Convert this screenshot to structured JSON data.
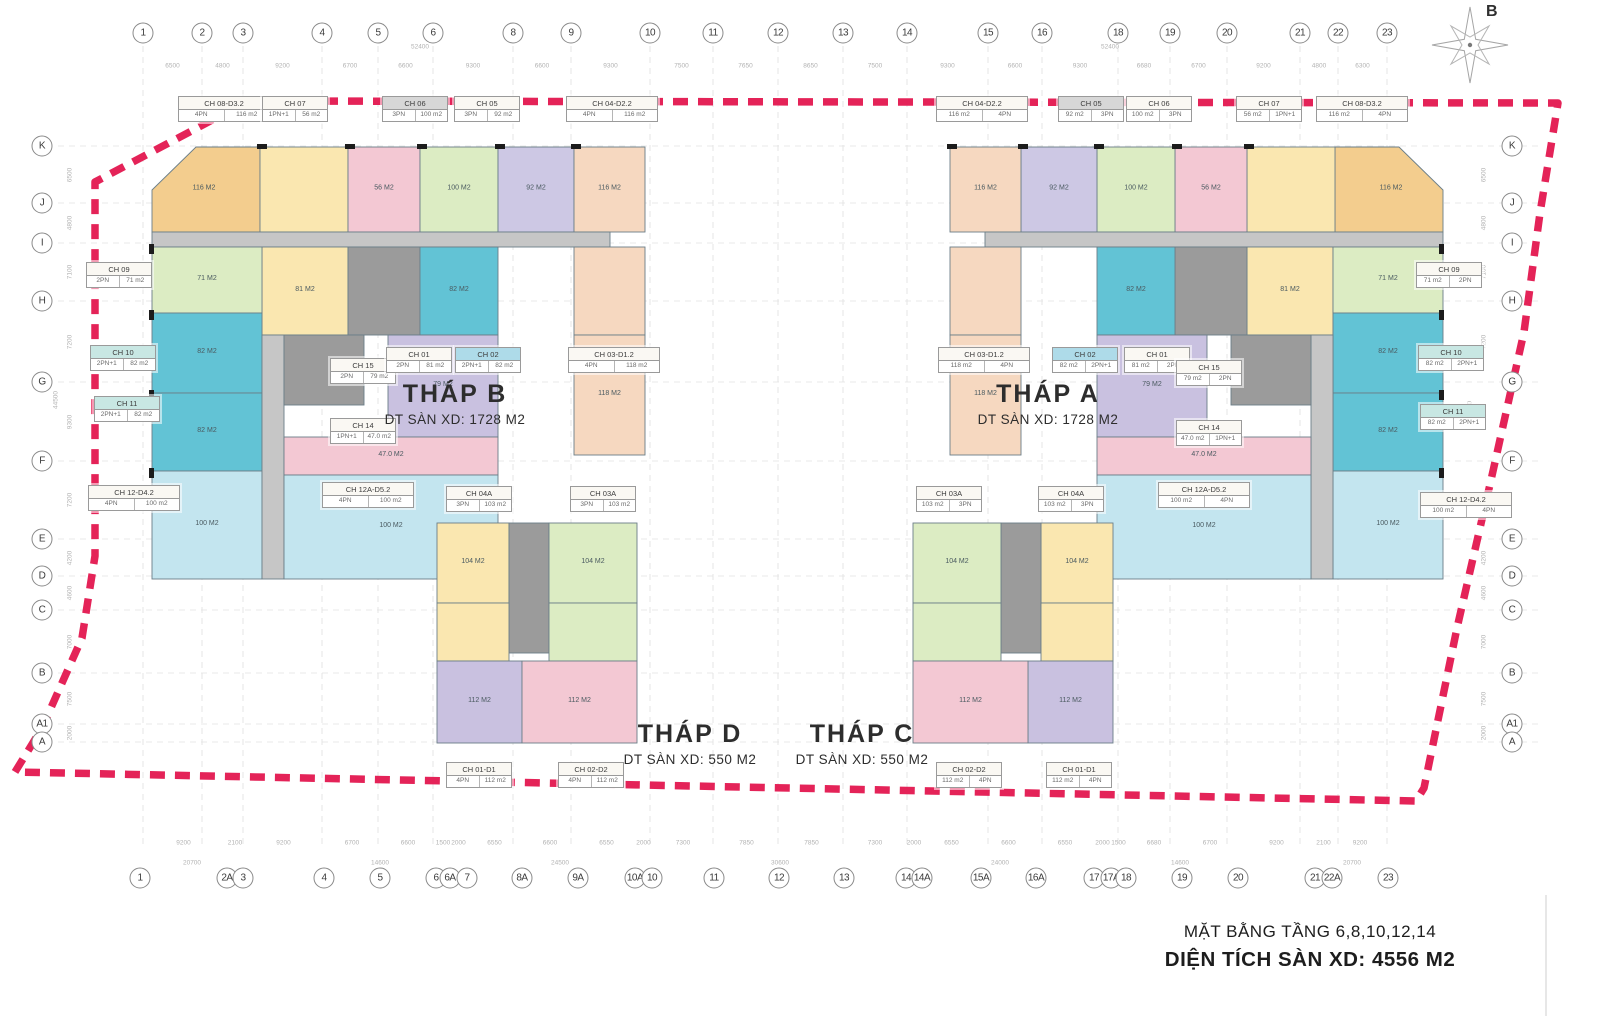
{
  "title_block": {
    "line1": "MẶT BẰNG TẦNG 6,8,10,12,14",
    "line2": "DIỆN TÍCH SÀN XD: 4556 M2"
  },
  "compass": {
    "label": "B"
  },
  "towers": [
    {
      "name": "THÁP B",
      "area": "DT SÀN XD: 1728 M2",
      "x": 455,
      "y": 380
    },
    {
      "name": "THÁP A",
      "area": "DT SÀN XD: 1728 M2",
      "x": 1048,
      "y": 380
    },
    {
      "name": "THÁP D",
      "area": "DT SÀN XD: 550 M2",
      "x": 690,
      "y": 720
    },
    {
      "name": "THÁP C",
      "area": "DT SÀN XD: 550 M2",
      "x": 862,
      "y": 720
    }
  ],
  "axes": {
    "top": [
      {
        "l": "1",
        "x": 143
      },
      {
        "l": "2",
        "x": 202
      },
      {
        "l": "3",
        "x": 243
      },
      {
        "l": "4",
        "x": 322
      },
      {
        "l": "5",
        "x": 378
      },
      {
        "l": "6",
        "x": 433
      },
      {
        "l": "8",
        "x": 513
      },
      {
        "l": "9",
        "x": 571
      },
      {
        "l": "10",
        "x": 650
      },
      {
        "l": "11",
        "x": 713
      },
      {
        "l": "12",
        "x": 778
      },
      {
        "l": "13",
        "x": 843
      },
      {
        "l": "14",
        "x": 907
      },
      {
        "l": "15",
        "x": 988
      },
      {
        "l": "16",
        "x": 1042
      },
      {
        "l": "18",
        "x": 1118
      },
      {
        "l": "19",
        "x": 1170
      },
      {
        "l": "20",
        "x": 1227
      },
      {
        "l": "21",
        "x": 1300
      },
      {
        "l": "22",
        "x": 1338
      },
      {
        "l": "23",
        "x": 1387
      }
    ],
    "bottom": [
      {
        "l": "1",
        "x": 140
      },
      {
        "l": "2A",
        "x": 227
      },
      {
        "l": "3",
        "x": 243
      },
      {
        "l": "4",
        "x": 324
      },
      {
        "l": "5",
        "x": 380
      },
      {
        "l": "6",
        "x": 436
      },
      {
        "l": "6A",
        "x": 450
      },
      {
        "l": "7",
        "x": 467
      },
      {
        "l": "8A",
        "x": 522
      },
      {
        "l": "9A",
        "x": 578
      },
      {
        "l": "10A",
        "x": 635
      },
      {
        "l": "10",
        "x": 652
      },
      {
        "l": "11",
        "x": 714
      },
      {
        "l": "12",
        "x": 779
      },
      {
        "l": "13",
        "x": 844
      },
      {
        "l": "14",
        "x": 906
      },
      {
        "l": "14A",
        "x": 922
      },
      {
        "l": "15A",
        "x": 981
      },
      {
        "l": "16A",
        "x": 1036
      },
      {
        "l": "17",
        "x": 1094
      },
      {
        "l": "17A",
        "x": 1111
      },
      {
        "l": "18",
        "x": 1126
      },
      {
        "l": "19",
        "x": 1182
      },
      {
        "l": "20",
        "x": 1238
      },
      {
        "l": "21",
        "x": 1315
      },
      {
        "l": "22A",
        "x": 1332
      },
      {
        "l": "23",
        "x": 1388
      }
    ],
    "left": [
      {
        "l": "K",
        "y": 146
      },
      {
        "l": "J",
        "y": 203
      },
      {
        "l": "I",
        "y": 243
      },
      {
        "l": "H",
        "y": 301
      },
      {
        "l": "G",
        "y": 382
      },
      {
        "l": "F",
        "y": 461
      },
      {
        "l": "E",
        "y": 539
      },
      {
        "l": "D",
        "y": 576
      },
      {
        "l": "C",
        "y": 610
      },
      {
        "l": "B",
        "y": 673
      },
      {
        "l": "A1",
        "y": 724
      },
      {
        "l": "A",
        "y": 742
      }
    ],
    "right": [
      {
        "l": "K",
        "y": 146
      },
      {
        "l": "J",
        "y": 203
      },
      {
        "l": "I",
        "y": 243
      },
      {
        "l": "H",
        "y": 301
      },
      {
        "l": "G",
        "y": 382
      },
      {
        "l": "F",
        "y": 461
      },
      {
        "l": "E",
        "y": 539
      },
      {
        "l": "D",
        "y": 576
      },
      {
        "l": "C",
        "y": 610
      },
      {
        "l": "B",
        "y": 673
      },
      {
        "l": "A1",
        "y": 724
      },
      {
        "l": "A",
        "y": 742
      }
    ]
  },
  "dims": {
    "top": [
      "6500",
      "4800",
      "9200",
      "6700",
      "6600",
      "9300",
      "6600",
      "9300",
      "7500",
      "7650",
      "8650",
      "7500",
      "9300",
      "6600",
      "9300",
      "6680",
      "6700",
      "9200",
      "4800",
      "6300"
    ],
    "top_overall": [
      {
        "v": "52400",
        "x": 420
      },
      {
        "v": "52400",
        "x": 1110
      }
    ],
    "bottom": [
      "9200",
      "2100",
      "9200",
      "6700",
      "6600",
      "1500",
      "2000",
      "6550",
      "6600",
      "6550",
      "2000",
      "7300",
      "7850",
      "7850",
      "7300",
      "2000",
      "6550",
      "6600",
      "6550",
      "2000",
      "1500",
      "6680",
      "6700",
      "9200",
      "2100",
      "9200"
    ],
    "bottom_overall": [
      {
        "v": "20700",
        "x": 192
      },
      {
        "v": "14600",
        "x": 380
      },
      {
        "v": "24500",
        "x": 560
      },
      {
        "v": "30600",
        "x": 780
      },
      {
        "v": "24000",
        "x": 1000
      },
      {
        "v": "14600",
        "x": 1180
      },
      {
        "v": "20700",
        "x": 1352
      }
    ],
    "side": [
      "6500",
      "4800",
      "7100",
      "7200",
      "9300",
      "7200",
      "4200",
      "4600",
      "7000",
      "7500",
      "2000"
    ],
    "side_overall": "44500"
  },
  "unit_labels": [
    {
      "n": "CH 08-D3.2",
      "a": "4PN",
      "b": "116 m2",
      "x": 178,
      "y": 96,
      "hl": "none"
    },
    {
      "n": "CH 07",
      "a": "1PN+1",
      "b": "56 m2",
      "x": 262,
      "y": 96,
      "hl": "none"
    },
    {
      "n": "CH 06",
      "a": "3PN",
      "b": "100 m2",
      "x": 382,
      "y": 96,
      "hl": "gray"
    },
    {
      "n": "CH 05",
      "a": "3PN",
      "b": "92 m2",
      "x": 454,
      "y": 96,
      "hl": "none"
    },
    {
      "n": "CH 04-D2.2",
      "a": "4PN",
      "b": "116 m2",
      "x": 566,
      "y": 96,
      "hl": "none"
    },
    {
      "n": "CH 04-D2.2",
      "a": "116 m2",
      "b": "4PN",
      "x": 936,
      "y": 96,
      "hl": "none"
    },
    {
      "n": "CH 05",
      "a": "92 m2",
      "b": "3PN",
      "x": 1058,
      "y": 96,
      "hl": "gray"
    },
    {
      "n": "CH 06",
      "a": "100 m2",
      "b": "3PN",
      "x": 1126,
      "y": 96,
      "hl": "none"
    },
    {
      "n": "CH 07",
      "a": "56 m2",
      "b": "1PN+1",
      "x": 1236,
      "y": 96,
      "hl": "none"
    },
    {
      "n": "CH 08-D3.2",
      "a": "116 m2",
      "b": "4PN",
      "x": 1316,
      "y": 96,
      "hl": "none"
    },
    {
      "n": "CH 09",
      "a": "2PN",
      "b": "71 m2",
      "x": 86,
      "y": 262,
      "hl": "none"
    },
    {
      "n": "CH 10",
      "a": "2PN+1",
      "b": "82 m2",
      "x": 90,
      "y": 345,
      "hl": "teal"
    },
    {
      "n": "CH 11",
      "a": "2PN+1",
      "b": "82 m2",
      "x": 94,
      "y": 396,
      "hl": "teal"
    },
    {
      "n": "CH 12-D4.2",
      "a": "4PN",
      "b": "100 m2",
      "x": 88,
      "y": 485,
      "hl": "none"
    },
    {
      "n": "CH 09",
      "a": "71 m2",
      "b": "2PN",
      "x": 1416,
      "y": 262,
      "hl": "none"
    },
    {
      "n": "CH 10",
      "a": "82 m2",
      "b": "2PN+1",
      "x": 1418,
      "y": 345,
      "hl": "teal"
    },
    {
      "n": "CH 11",
      "a": "82 m2",
      "b": "2PN+1",
      "x": 1420,
      "y": 404,
      "hl": "teal"
    },
    {
      "n": "CH 12-D4.2",
      "a": "100 m2",
      "b": "4PN",
      "x": 1420,
      "y": 492,
      "hl": "none"
    },
    {
      "n": "CH 15",
      "a": "2PN",
      "b": "79 m2",
      "x": 330,
      "y": 358,
      "hl": "none"
    },
    {
      "n": "CH 01",
      "a": "2PN",
      "b": "81 m2",
      "x": 386,
      "y": 347,
      "hl": "none"
    },
    {
      "n": "CH 02",
      "a": "2PN+1",
      "b": "82 m2",
      "x": 455,
      "y": 347,
      "hl": "blue"
    },
    {
      "n": "CH 03-D1.2",
      "a": "4PN",
      "b": "118 m2",
      "x": 568,
      "y": 347,
      "hl": "none"
    },
    {
      "n": "CH 14",
      "a": "1PN+1",
      "b": "47.0 m2",
      "x": 330,
      "y": 418,
      "hl": "none"
    },
    {
      "n": "CH 03-D1.2",
      "a": "118 m2",
      "b": "4PN",
      "x": 938,
      "y": 347,
      "hl": "none"
    },
    {
      "n": "CH 02",
      "a": "82 m2",
      "b": "2PN+1",
      "x": 1052,
      "y": 347,
      "hl": "blue"
    },
    {
      "n": "CH 01",
      "a": "81 m2",
      "b": "2PN",
      "x": 1124,
      "y": 347,
      "hl": "none"
    },
    {
      "n": "CH 15",
      "a": "79 m2",
      "b": "2PN",
      "x": 1176,
      "y": 360,
      "hl": "none"
    },
    {
      "n": "CH 14",
      "a": "47.0 m2",
      "b": "1PN+1",
      "x": 1176,
      "y": 420,
      "hl": "none"
    },
    {
      "n": "CH 12A-D5.2",
      "a": "4PN",
      "b": "100 m2",
      "x": 322,
      "y": 482,
      "hl": "none"
    },
    {
      "n": "CH 04A",
      "a": "3PN",
      "b": "103 m2",
      "x": 446,
      "y": 486,
      "hl": "none"
    },
    {
      "n": "CH 03A",
      "a": "3PN",
      "b": "103 m2",
      "x": 570,
      "y": 486,
      "hl": "none"
    },
    {
      "n": "CH 03A",
      "a": "103 m2",
      "b": "3PN",
      "x": 916,
      "y": 486,
      "hl": "none"
    },
    {
      "n": "CH 04A",
      "a": "103 m2",
      "b": "3PN",
      "x": 1038,
      "y": 486,
      "hl": "none"
    },
    {
      "n": "CH 12A-D5.2",
      "a": "100 m2",
      "b": "4PN",
      "x": 1158,
      "y": 482,
      "hl": "none"
    },
    {
      "n": "CH 01-D1",
      "a": "4PN",
      "b": "112 m2",
      "x": 446,
      "y": 762,
      "hl": "none"
    },
    {
      "n": "CH 02-D2",
      "a": "4PN",
      "b": "112 m2",
      "x": 558,
      "y": 762,
      "hl": "none"
    },
    {
      "n": "CH 02-D2",
      "a": "112 m2",
      "b": "4PN",
      "x": 936,
      "y": 762,
      "hl": "none"
    },
    {
      "n": "CH 01-D1",
      "a": "112 m2",
      "b": "4PN",
      "x": 1046,
      "y": 762,
      "hl": "none"
    }
  ],
  "palette": {
    "orange": "#f3cd8e",
    "yellow": "#fae7b0",
    "pink": "#f3c8d3",
    "green": "#dcecc3",
    "lavender": "#cdc8e4",
    "peach": "#f6d8c0",
    "teal": "#62c3d5",
    "paleblue": "#c3e5ef",
    "purple": "#c9c1e0",
    "corr": "#c6c6c6",
    "core": "#9b9b9b"
  },
  "blocks": [
    {
      "pts": [
        [
          152,
          190
        ],
        [
          196,
          147
        ],
        [
          260,
          147
        ],
        [
          260,
          232
        ],
        [
          152,
          232
        ]
      ],
      "c": "orange",
      "t": "116 M2"
    },
    {
      "x": 260,
      "y": 147,
      "w": 88,
      "h": 85,
      "c": "yellow"
    },
    {
      "x": 348,
      "y": 147,
      "w": 72,
      "h": 85,
      "c": "pink",
      "t": "56 M2"
    },
    {
      "x": 420,
      "y": 147,
      "w": 78,
      "h": 85,
      "c": "green",
      "t": "100 M2"
    },
    {
      "x": 498,
      "y": 147,
      "w": 76,
      "h": 85,
      "c": "lavender",
      "t": "92 M2"
    },
    {
      "x": 574,
      "y": 147,
      "w": 71,
      "h": 85,
      "c": "peach",
      "t": "116 M2"
    },
    {
      "x": 152,
      "y": 232,
      "w": 458,
      "h": 15,
      "c": "corr"
    },
    {
      "x": 262,
      "y": 247,
      "w": 86,
      "h": 88,
      "c": "yellow",
      "t": "81 M2"
    },
    {
      "x": 348,
      "y": 247,
      "w": 72,
      "h": 88,
      "c": "core"
    },
    {
      "x": 420,
      "y": 247,
      "w": 78,
      "h": 88,
      "c": "teal",
      "t": "82 M2"
    },
    {
      "x": 574,
      "y": 247,
      "w": 71,
      "h": 88,
      "c": "peach"
    },
    {
      "x": 574,
      "y": 335,
      "w": 71,
      "h": 120,
      "c": "peach",
      "t": "118 M2"
    },
    {
      "x": 152,
      "y": 247,
      "w": 110,
      "h": 66,
      "c": "green",
      "t": "71 M2"
    },
    {
      "x": 152,
      "y": 313,
      "w": 110,
      "h": 80,
      "c": "teal",
      "t": "82 M2"
    },
    {
      "x": 152,
      "y": 393,
      "w": 110,
      "h": 78,
      "c": "teal",
      "t": "82 M2"
    },
    {
      "x": 152,
      "y": 471,
      "w": 110,
      "h": 108,
      "c": "paleblue",
      "t": "100 M2"
    },
    {
      "x": 262,
      "y": 335,
      "w": 22,
      "h": 244,
      "c": "corr"
    },
    {
      "x": 284,
      "y": 335,
      "w": 80,
      "h": 70,
      "c": "core"
    },
    {
      "x": 388,
      "y": 335,
      "w": 110,
      "h": 102,
      "c": "purple",
      "t": "79 M2"
    },
    {
      "x": 284,
      "y": 437,
      "w": 214,
      "h": 38,
      "c": "pink",
      "t": "47.0 M2"
    },
    {
      "x": 284,
      "y": 475,
      "w": 214,
      "h": 104,
      "c": "paleblue",
      "t": "100 M2"
    },
    {
      "pts": [
        [
          1443,
          190
        ],
        [
          1399,
          147
        ],
        [
          1335,
          147
        ],
        [
          1335,
          232
        ],
        [
          1443,
          232
        ]
      ],
      "c": "orange",
      "t": "116 M2"
    },
    {
      "x": 1247,
      "y": 147,
      "w": 88,
      "h": 85,
      "c": "yellow"
    },
    {
      "x": 1175,
      "y": 147,
      "w": 72,
      "h": 85,
      "c": "pink",
      "t": "56 M2"
    },
    {
      "x": 1097,
      "y": 147,
      "w": 78,
      "h": 85,
      "c": "green",
      "t": "100 M2"
    },
    {
      "x": 1021,
      "y": 147,
      "w": 76,
      "h": 85,
      "c": "lavender",
      "t": "92 M2"
    },
    {
      "x": 950,
      "y": 147,
      "w": 71,
      "h": 85,
      "c": "peach",
      "t": "116 M2"
    },
    {
      "x": 985,
      "y": 232,
      "w": 458,
      "h": 15,
      "c": "corr"
    },
    {
      "x": 1247,
      "y": 247,
      "w": 86,
      "h": 88,
      "c": "yellow",
      "t": "81 M2"
    },
    {
      "x": 1175,
      "y": 247,
      "w": 72,
      "h": 88,
      "c": "core"
    },
    {
      "x": 1097,
      "y": 247,
      "w": 78,
      "h": 88,
      "c": "teal",
      "t": "82 M2"
    },
    {
      "x": 950,
      "y": 247,
      "w": 71,
      "h": 88,
      "c": "peach"
    },
    {
      "x": 950,
      "y": 335,
      "w": 71,
      "h": 120,
      "c": "peach",
      "t": "118 M2"
    },
    {
      "x": 1333,
      "y": 247,
      "w": 110,
      "h": 66,
      "c": "green",
      "t": "71 M2"
    },
    {
      "x": 1333,
      "y": 313,
      "w": 110,
      "h": 80,
      "c": "teal",
      "t": "82 M2"
    },
    {
      "x": 1333,
      "y": 393,
      "w": 110,
      "h": 78,
      "c": "teal",
      "t": "82 M2"
    },
    {
      "x": 1333,
      "y": 471,
      "w": 110,
      "h": 108,
      "c": "paleblue",
      "t": "100 M2"
    },
    {
      "x": 1311,
      "y": 335,
      "w": 22,
      "h": 244,
      "c": "corr"
    },
    {
      "x": 1231,
      "y": 335,
      "w": 80,
      "h": 70,
      "c": "core"
    },
    {
      "x": 1097,
      "y": 335,
      "w": 110,
      "h": 102,
      "c": "purple",
      "t": "79 M2"
    },
    {
      "x": 1097,
      "y": 437,
      "w": 214,
      "h": 38,
      "c": "pink",
      "t": "47.0 M2"
    },
    {
      "x": 1097,
      "y": 475,
      "w": 214,
      "h": 104,
      "c": "paleblue",
      "t": "100 M2"
    },
    {
      "x": 437,
      "y": 523,
      "w": 72,
      "h": 80,
      "c": "yellow",
      "t": "104 M2"
    },
    {
      "x": 509,
      "y": 523,
      "w": 40,
      "h": 130,
      "c": "core"
    },
    {
      "x": 549,
      "y": 523,
      "w": 88,
      "h": 80,
      "c": "green",
      "t": "104 M2"
    },
    {
      "x": 437,
      "y": 603,
      "w": 72,
      "h": 58,
      "c": "yellow"
    },
    {
      "x": 549,
      "y": 603,
      "w": 88,
      "h": 58,
      "c": "green"
    },
    {
      "x": 437,
      "y": 661,
      "w": 85,
      "h": 82,
      "c": "purple",
      "t": "112 M2"
    },
    {
      "x": 522,
      "y": 661,
      "w": 115,
      "h": 82,
      "c": "pink",
      "t": "112 M2"
    },
    {
      "x": 1041,
      "y": 523,
      "w": 72,
      "h": 80,
      "c": "yellow",
      "t": "104 M2"
    },
    {
      "x": 1001,
      "y": 523,
      "w": 40,
      "h": 130,
      "c": "core"
    },
    {
      "x": 913,
      "y": 523,
      "w": 88,
      "h": 80,
      "c": "green",
      "t": "104 M2"
    },
    {
      "x": 1041,
      "y": 603,
      "w": 72,
      "h": 58,
      "c": "yellow"
    },
    {
      "x": 913,
      "y": 603,
      "w": 88,
      "h": 58,
      "c": "green"
    },
    {
      "x": 1028,
      "y": 661,
      "w": 85,
      "h": 82,
      "c": "purple",
      "t": "112 M2"
    },
    {
      "x": 913,
      "y": 661,
      "w": 115,
      "h": 82,
      "c": "pink",
      "t": "112 M2"
    }
  ],
  "boundary": {
    "color": "#e3174f",
    "points": [
      [
        248,
        101
      ],
      [
        1558,
        103
      ],
      [
        1540,
        213
      ],
      [
        1524,
        332
      ],
      [
        1491,
        480
      ],
      [
        1457,
        628
      ],
      [
        1424,
        788
      ],
      [
        1416,
        801
      ],
      [
        15,
        772
      ],
      [
        42,
        728
      ],
      [
        82,
        638
      ],
      [
        95,
        556
      ],
      [
        95,
        182
      ]
    ]
  }
}
